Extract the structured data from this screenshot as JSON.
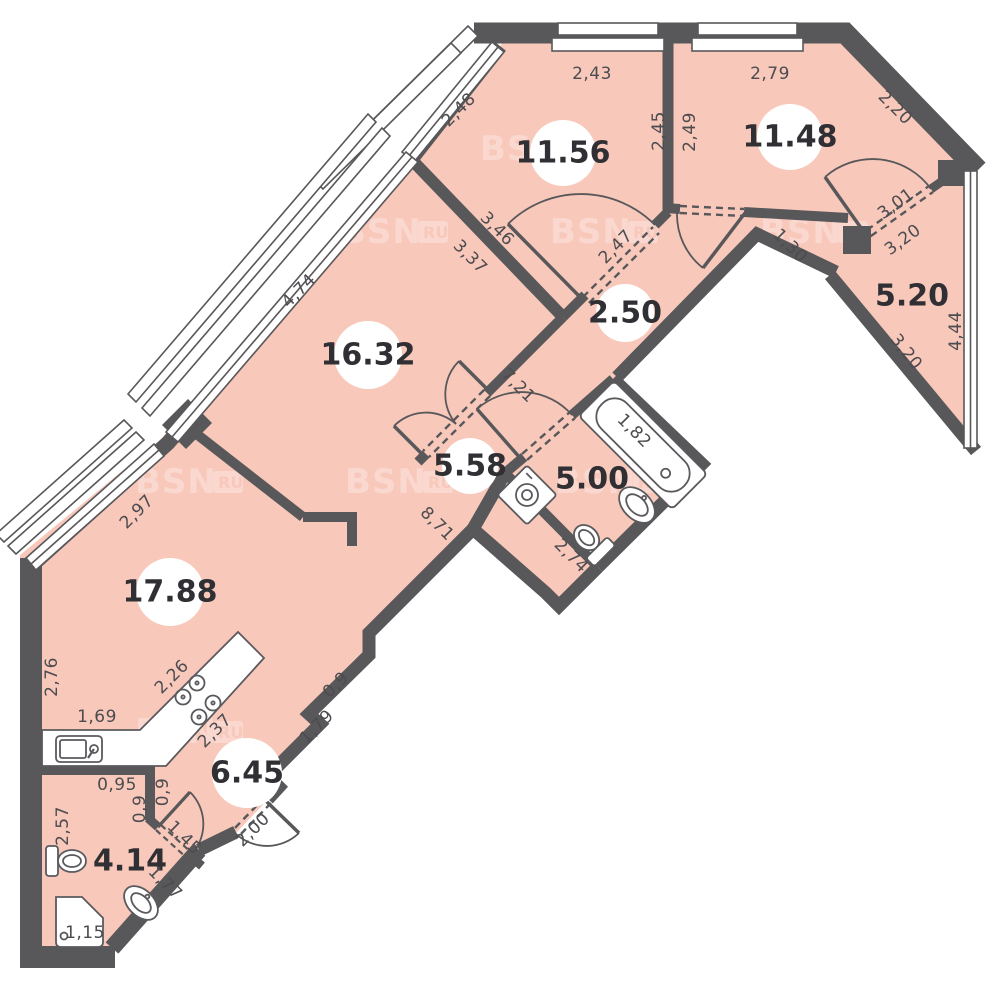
{
  "plan": {
    "title": "apartment-floor-plan",
    "watermark_text": "BSN",
    "watermark_badge": "RU",
    "colors": {
      "floor": "#f8c8ba",
      "wall": "#58585b",
      "fixture_stroke": "#5a5a5e",
      "dim_text": "#4c4c50",
      "label_text": "#2f2f34",
      "background": "#ffffff"
    },
    "rooms": [
      {
        "id": "room-1156",
        "area": "11.56",
        "x": 563,
        "y": 153,
        "circle": true,
        "r": 33,
        "fs": 30
      },
      {
        "id": "room-1148",
        "area": "11.48",
        "x": 790,
        "y": 137,
        "circle": true,
        "r": 33,
        "fs": 30
      },
      {
        "id": "hall-250",
        "area": "2.50",
        "x": 625,
        "y": 313,
        "circle": true,
        "r": 29,
        "fs": 26
      },
      {
        "id": "room-520",
        "area": "5.20",
        "x": 912,
        "y": 296,
        "circle": false,
        "r": 0,
        "fs": 30
      },
      {
        "id": "room-1632",
        "area": "16.32",
        "x": 368,
        "y": 355,
        "circle": true,
        "r": 34,
        "fs": 30
      },
      {
        "id": "hall-558",
        "area": "5.58",
        "x": 470,
        "y": 466,
        "circle": true,
        "r": 28,
        "fs": 26
      },
      {
        "id": "bath-500",
        "area": "5.00",
        "x": 592,
        "y": 479,
        "circle": false,
        "r": 0,
        "fs": 28
      },
      {
        "id": "room-1788",
        "area": "17.88",
        "x": 170,
        "y": 592,
        "circle": true,
        "r": 34,
        "fs": 30
      },
      {
        "id": "hall-645",
        "area": "6.45",
        "x": 247,
        "y": 773,
        "circle": true,
        "r": 35,
        "fs": 30
      },
      {
        "id": "bath-414",
        "area": "4.14",
        "x": 130,
        "y": 861,
        "circle": false,
        "r": 0,
        "fs": 28
      }
    ],
    "dimensions": [
      {
        "text": "2,43",
        "x": 592,
        "y": 74,
        "rot": 0
      },
      {
        "text": "2,79",
        "x": 770,
        "y": 74,
        "rot": 0
      },
      {
        "text": "2,48",
        "x": 459,
        "y": 110,
        "rot": -45
      },
      {
        "text": "2,45",
        "x": 659,
        "y": 131,
        "rot": -90
      },
      {
        "text": "2,49",
        "x": 690,
        "y": 132,
        "rot": -90
      },
      {
        "text": "2,20",
        "x": 895,
        "y": 108,
        "rot": 45
      },
      {
        "text": "3,01",
        "x": 896,
        "y": 204,
        "rot": -36
      },
      {
        "text": "3,20",
        "x": 903,
        "y": 240,
        "rot": -36
      },
      {
        "text": "3,20",
        "x": 906,
        "y": 352,
        "rot": 52
      },
      {
        "text": "4,44",
        "x": 956,
        "y": 331,
        "rot": -90
      },
      {
        "text": "1,30",
        "x": 790,
        "y": 246,
        "rot": 45
      },
      {
        "text": "3,46",
        "x": 497,
        "y": 229,
        "rot": 45
      },
      {
        "text": "3,37",
        "x": 470,
        "y": 257,
        "rot": 45
      },
      {
        "text": "2,47",
        "x": 616,
        "y": 247,
        "rot": -45
      },
      {
        "text": "4,74",
        "x": 299,
        "y": 291,
        "rot": -45
      },
      {
        "text": "7,21",
        "x": 518,
        "y": 386,
        "rot": 45
      },
      {
        "text": "2,97",
        "x": 137,
        "y": 512,
        "rot": -45
      },
      {
        "text": "8,71",
        "x": 437,
        "y": 524,
        "rot": 45
      },
      {
        "text": "1,82",
        "x": 634,
        "y": 431,
        "rot": 45
      },
      {
        "text": "2,74",
        "x": 571,
        "y": 556,
        "rot": 45
      },
      {
        "text": "2,76",
        "x": 52,
        "y": 677,
        "rot": -90
      },
      {
        "text": "2,26",
        "x": 172,
        "y": 677,
        "rot": -45
      },
      {
        "text": "1,69",
        "x": 97,
        "y": 717,
        "rot": 0
      },
      {
        "text": "2,37",
        "x": 215,
        "y": 731,
        "rot": -45
      },
      {
        "text": "0,9",
        "x": 336,
        "y": 685,
        "rot": -45
      },
      {
        "text": "1,79",
        "x": 317,
        "y": 727,
        "rot": -45
      },
      {
        "text": "0,95",
        "x": 117,
        "y": 785,
        "rot": 0
      },
      {
        "text": "0,9",
        "x": 163,
        "y": 792,
        "rot": -90
      },
      {
        "text": "0,9",
        "x": 140,
        "y": 809,
        "rot": -90
      },
      {
        "text": "1,45",
        "x": 184,
        "y": 838,
        "rot": 45
      },
      {
        "text": "2,00",
        "x": 253,
        "y": 830,
        "rot": -45
      },
      {
        "text": "1,77",
        "x": 165,
        "y": 883,
        "rot": 45
      },
      {
        "text": "2,57",
        "x": 63,
        "y": 826,
        "rot": -90
      },
      {
        "text": "1,15",
        "x": 85,
        "y": 933,
        "rot": 0
      }
    ],
    "watermarks": [
      {
        "x": 340,
        "y": 243
      },
      {
        "x": 550,
        "y": 243
      },
      {
        "x": 760,
        "y": 243
      },
      {
        "x": 135,
        "y": 493
      },
      {
        "x": 345,
        "y": 493
      },
      {
        "x": 555,
        "y": 493
      },
      {
        "x": 135,
        "y": 743
      },
      {
        "x": 480,
        "y": 160
      }
    ]
  }
}
